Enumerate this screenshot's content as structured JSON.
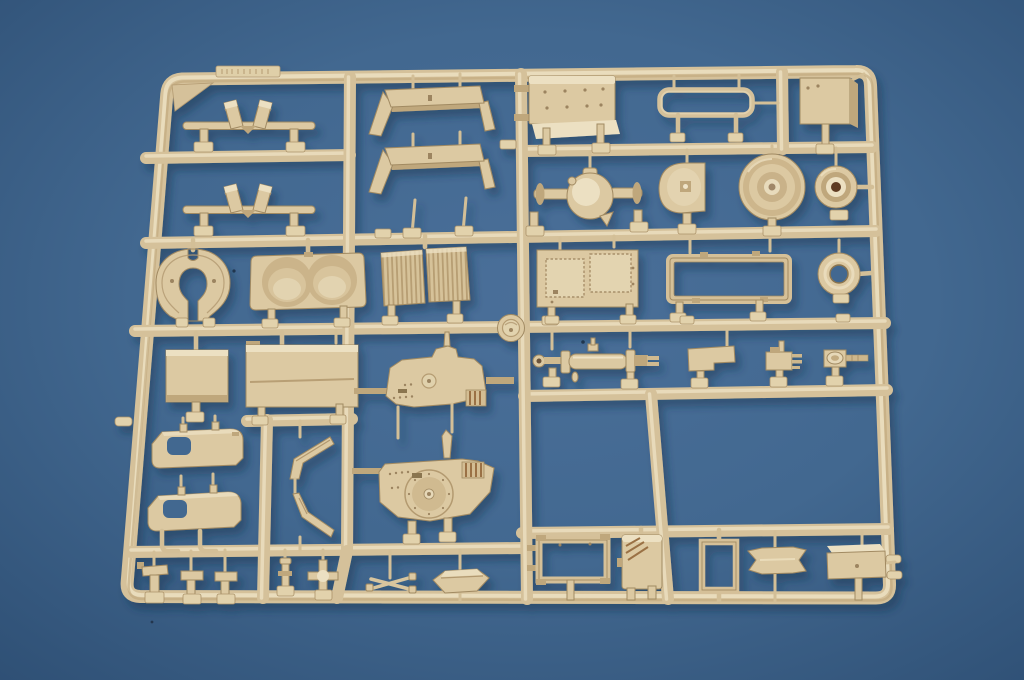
{
  "scene": {
    "type": "photograph",
    "description": "Top-down photo of a tan injection-molded plastic model kit sprue (parts runner) containing about 45 unpainted military-vehicle parts, lying on a blue fabric surface with soft vignette and drop shadow toward lower right",
    "subject": "model kit sprue with molded parts",
    "surface": "blue cloth backdrop",
    "lighting": "soft light from upper left, shadows cast down-right",
    "text_visible": "none legible (small embossed part-number tabs are unreadable)"
  },
  "colors": {
    "bg_center": "#4a6f99",
    "bg_mid": "#426890",
    "bg_edge": "#2e4f74",
    "plastic_base": "#d5c19a",
    "plastic_part": "#dcc9a2",
    "plastic_light": "#ece0c2",
    "plastic_mid": "#d3bf97",
    "plastic_dark": "#bfa77c",
    "plastic_deep": "#9c8460",
    "plastic_outline": "#a18a62",
    "hub_bore_brown": "#5e3a22",
    "shadow": "#16304e"
  },
  "sprue": {
    "frame": "rounded rectangular outer runner, slightly keystoned by camera angle",
    "grid": "three full-width horizontal runners plus section dividers and five vertical runners",
    "gate_tabs": "small rounded pads with illegible embossed part numbers beside each part",
    "corner_gusset": "triangular web in top-left corner",
    "embossed_strip": "raised unreadable label strip on top runner"
  },
  "parts": [
    {
      "name": "mud-flap-bracket-pair-a",
      "desc": "bar with two tilted flap panels in a V, top-left"
    },
    {
      "name": "mud-flap-bracket-pair-b",
      "desc": "identical second bar-with-flaps below"
    },
    {
      "name": "hood-panel-a",
      "desc": "bridge-shaped cowl panel, top center"
    },
    {
      "name": "hood-panel-b",
      "desc": "second bridge-shaped cowl panel"
    },
    {
      "name": "riveted-roof-plate",
      "desc": "rectangular plate with rivet dots and bottom flange"
    },
    {
      "name": "roll-bar",
      "desc": "rectangular tube loop rail with two legs"
    },
    {
      "name": "stowage-box",
      "desc": "small 3D box, top right"
    },
    {
      "name": "rear-axle-housing",
      "desc": "pumpkin-center axle with two shaft stubs"
    },
    {
      "name": "transmission-cover-plate",
      "desc": "D-shaped plate with center peg"
    },
    {
      "name": "brake-drum-large",
      "desc": "stepped circular drum with center bore"
    },
    {
      "name": "wheel-hub-small",
      "desc": "small drum with dark brown bore"
    },
    {
      "name": "towing-yoke",
      "desc": "horseshoe-shaped yoke with bottom slot"
    },
    {
      "name": "fan-shroud-panel",
      "desc": "panel with two large circular wells"
    },
    {
      "name": "radiator-grille-pair",
      "desc": "two vertically ribbed grille panels"
    },
    {
      "name": "hatch-plate-textured",
      "desc": "plate with two zigzag-edged raised pads"
    },
    {
      "name": "chassis-subframe",
      "desc": "open rectangular frame"
    },
    {
      "name": "idler-ring",
      "desc": "flat donut ring"
    },
    {
      "name": "runner-medallion",
      "desc": "round boss molded at runner junction"
    },
    {
      "name": "side-panel-small",
      "desc": "small flat rectangular panel"
    },
    {
      "name": "side-panel-large",
      "desc": "large flat panel with groove"
    },
    {
      "name": "cab-side-panel-upper",
      "desc": "elongated panel with rounded window cutout"
    },
    {
      "name": "cab-side-panel-lower",
      "desc": "second panel with cutout and L-legs"
    },
    {
      "name": "window-frame-bracket-upper",
      "desc": "angular Z bracket"
    },
    {
      "name": "window-frame-bracket-lower",
      "desc": "mirrored angular bracket"
    },
    {
      "name": "firewall-plate",
      "desc": "irregular plate, round cap, ribbed block, rivets"
    },
    {
      "name": "turret-floor-plate",
      "desc": "large plate with circular ring detail and ribbed block"
    },
    {
      "name": "hydraulic-cylinder",
      "desc": "long rod with sleeve, collars and eye ends"
    },
    {
      "name": "mounting-plate-small",
      "desc": "stepped small plate"
    },
    {
      "name": "gearbox-block",
      "desc": "small block with side pins"
    },
    {
      "name": "eyelet-bracket",
      "desc": "plate with oval ring and ribbed rod"
    },
    {
      "name": "pedal-bracket-1",
      "desc": "small L bracket"
    },
    {
      "name": "pedal-bracket-2",
      "desc": "small L bracket"
    },
    {
      "name": "pedal-bracket-3",
      "desc": "small L bracket"
    },
    {
      "name": "mast-pin",
      "desc": "short post with flange"
    },
    {
      "name": "cross-fitting",
      "desc": "plus-shaped fitting with boss"
    },
    {
      "name": "scissor-linkage",
      "desc": "thin X-shaped linkage"
    },
    {
      "name": "tool-box-lid",
      "desc": "elongated hexagonal lid"
    },
    {
      "name": "seat-frame",
      "desc": "open rectangle frame with corner tabs"
    },
    {
      "name": "stowage-bin-tall",
      "desc": "tall box with diagonal grooves and feet"
    },
    {
      "name": "door-frame",
      "desc": "tall open rectangle frame"
    },
    {
      "name": "clamp-plate-bowtie",
      "desc": "plate with notched arrow ends"
    },
    {
      "name": "battery-box",
      "desc": "shallow 3D box, bottom right"
    },
    {
      "name": "injection-stub-left",
      "desc": "gate stub protruding from left runner"
    },
    {
      "name": "injection-stub-right-pair",
      "desc": "two gate stubs protruding from right runner"
    },
    {
      "name": "dust-specks",
      "desc": "three tiny dark specks on backdrop"
    }
  ]
}
